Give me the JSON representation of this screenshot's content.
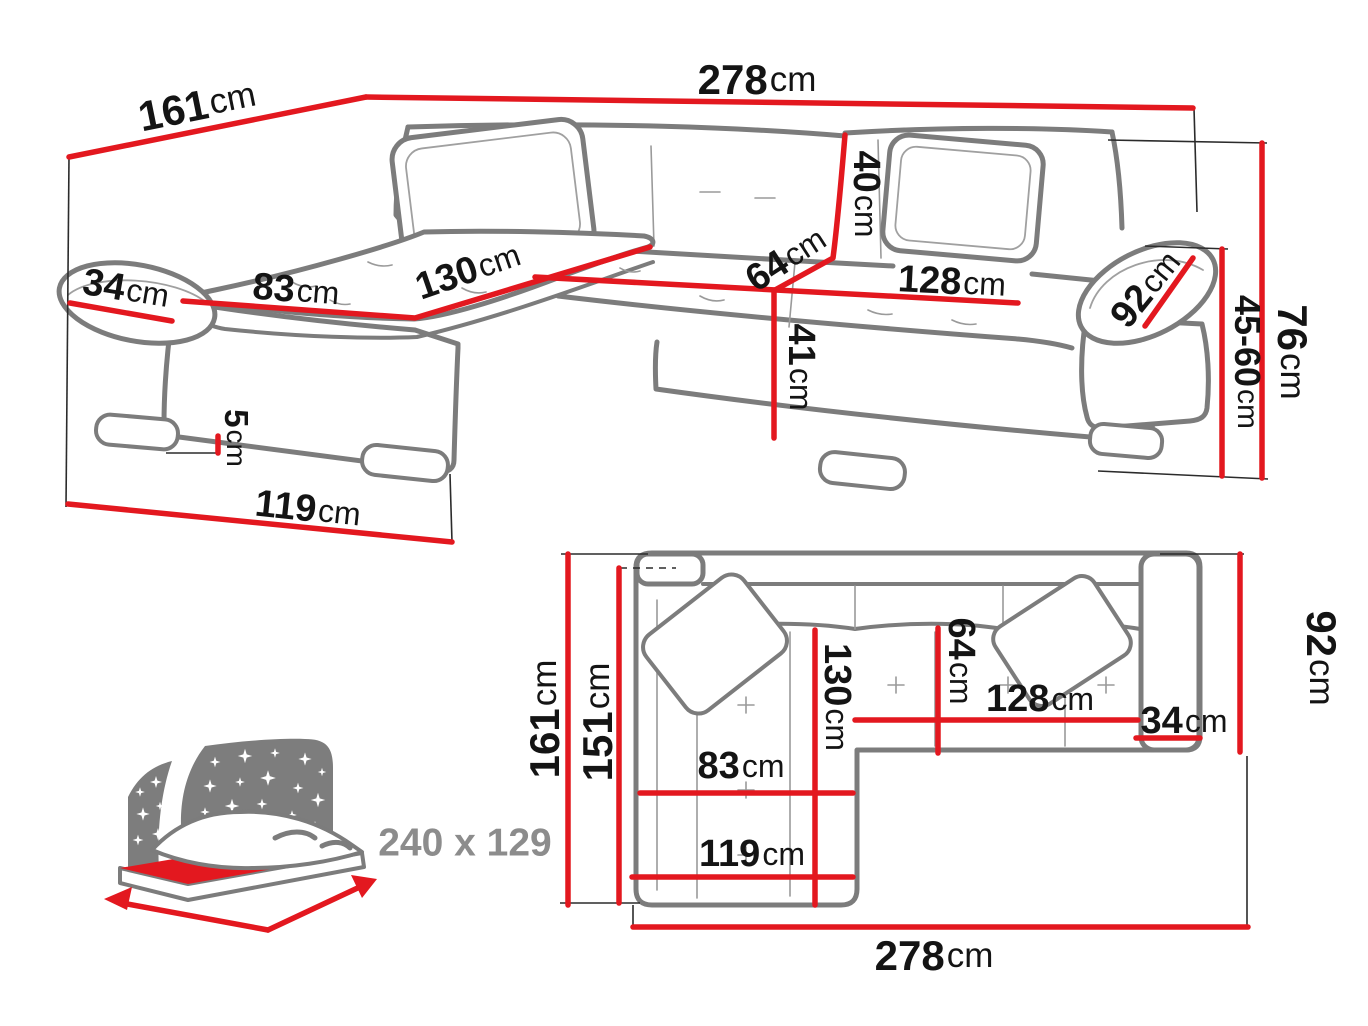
{
  "title": "Corner sofa bed dimensions diagram",
  "colors": {
    "dimension_red": "#e3181f",
    "outline_gray": "#7c7c7c",
    "text_black": "#141414",
    "icon_gray": "#7d7d7d",
    "text_gray": "#8c8c8c"
  },
  "perspective_view": {
    "dims": {
      "total_width": {
        "value": "278",
        "unit": "cm"
      },
      "total_depth": {
        "value": "161",
        "unit": "cm"
      },
      "left_arm_width": {
        "value": "34",
        "unit": "cm"
      },
      "chaise_seat_width": {
        "value": "83",
        "unit": "cm"
      },
      "chaise_length": {
        "value": "130",
        "unit": "cm"
      },
      "seat_depth": {
        "value": "64",
        "unit": "cm"
      },
      "backrest_height": {
        "value": "40",
        "unit": "cm"
      },
      "right_seat_width": {
        "value": "128",
        "unit": "cm"
      },
      "right_arm_length": {
        "value": "92",
        "unit": "cm"
      },
      "seat_height": {
        "value": "41",
        "unit": "cm"
      },
      "leg_height": {
        "value": "5",
        "unit": "cm"
      },
      "chaise_front_length": {
        "value": "119",
        "unit": "cm"
      },
      "total_height": {
        "value": "76",
        "unit": "cm"
      },
      "armrest_height": {
        "value": "45-60",
        "unit": "cm"
      }
    }
  },
  "plan_view": {
    "dims": {
      "total_depth": {
        "value": "161",
        "unit": "cm"
      },
      "inner_depth": {
        "value": "151",
        "unit": "cm"
      },
      "right_side_depth": {
        "value": "92",
        "unit": "cm"
      },
      "seat_depth": {
        "value": "64",
        "unit": "cm"
      },
      "chaise_length": {
        "value": "130",
        "unit": "cm"
      },
      "right_seat_width": {
        "value": "128",
        "unit": "cm"
      },
      "right_arm_width": {
        "value": "34",
        "unit": "cm"
      },
      "chaise_seat_width": {
        "value": "83",
        "unit": "cm"
      },
      "chaise_width": {
        "value": "119",
        "unit": "cm"
      },
      "total_width": {
        "value": "278",
        "unit": "cm"
      }
    }
  },
  "sleeping_function": {
    "icon": "sofa-bed-night-icon",
    "area_label": "240 x 129"
  }
}
